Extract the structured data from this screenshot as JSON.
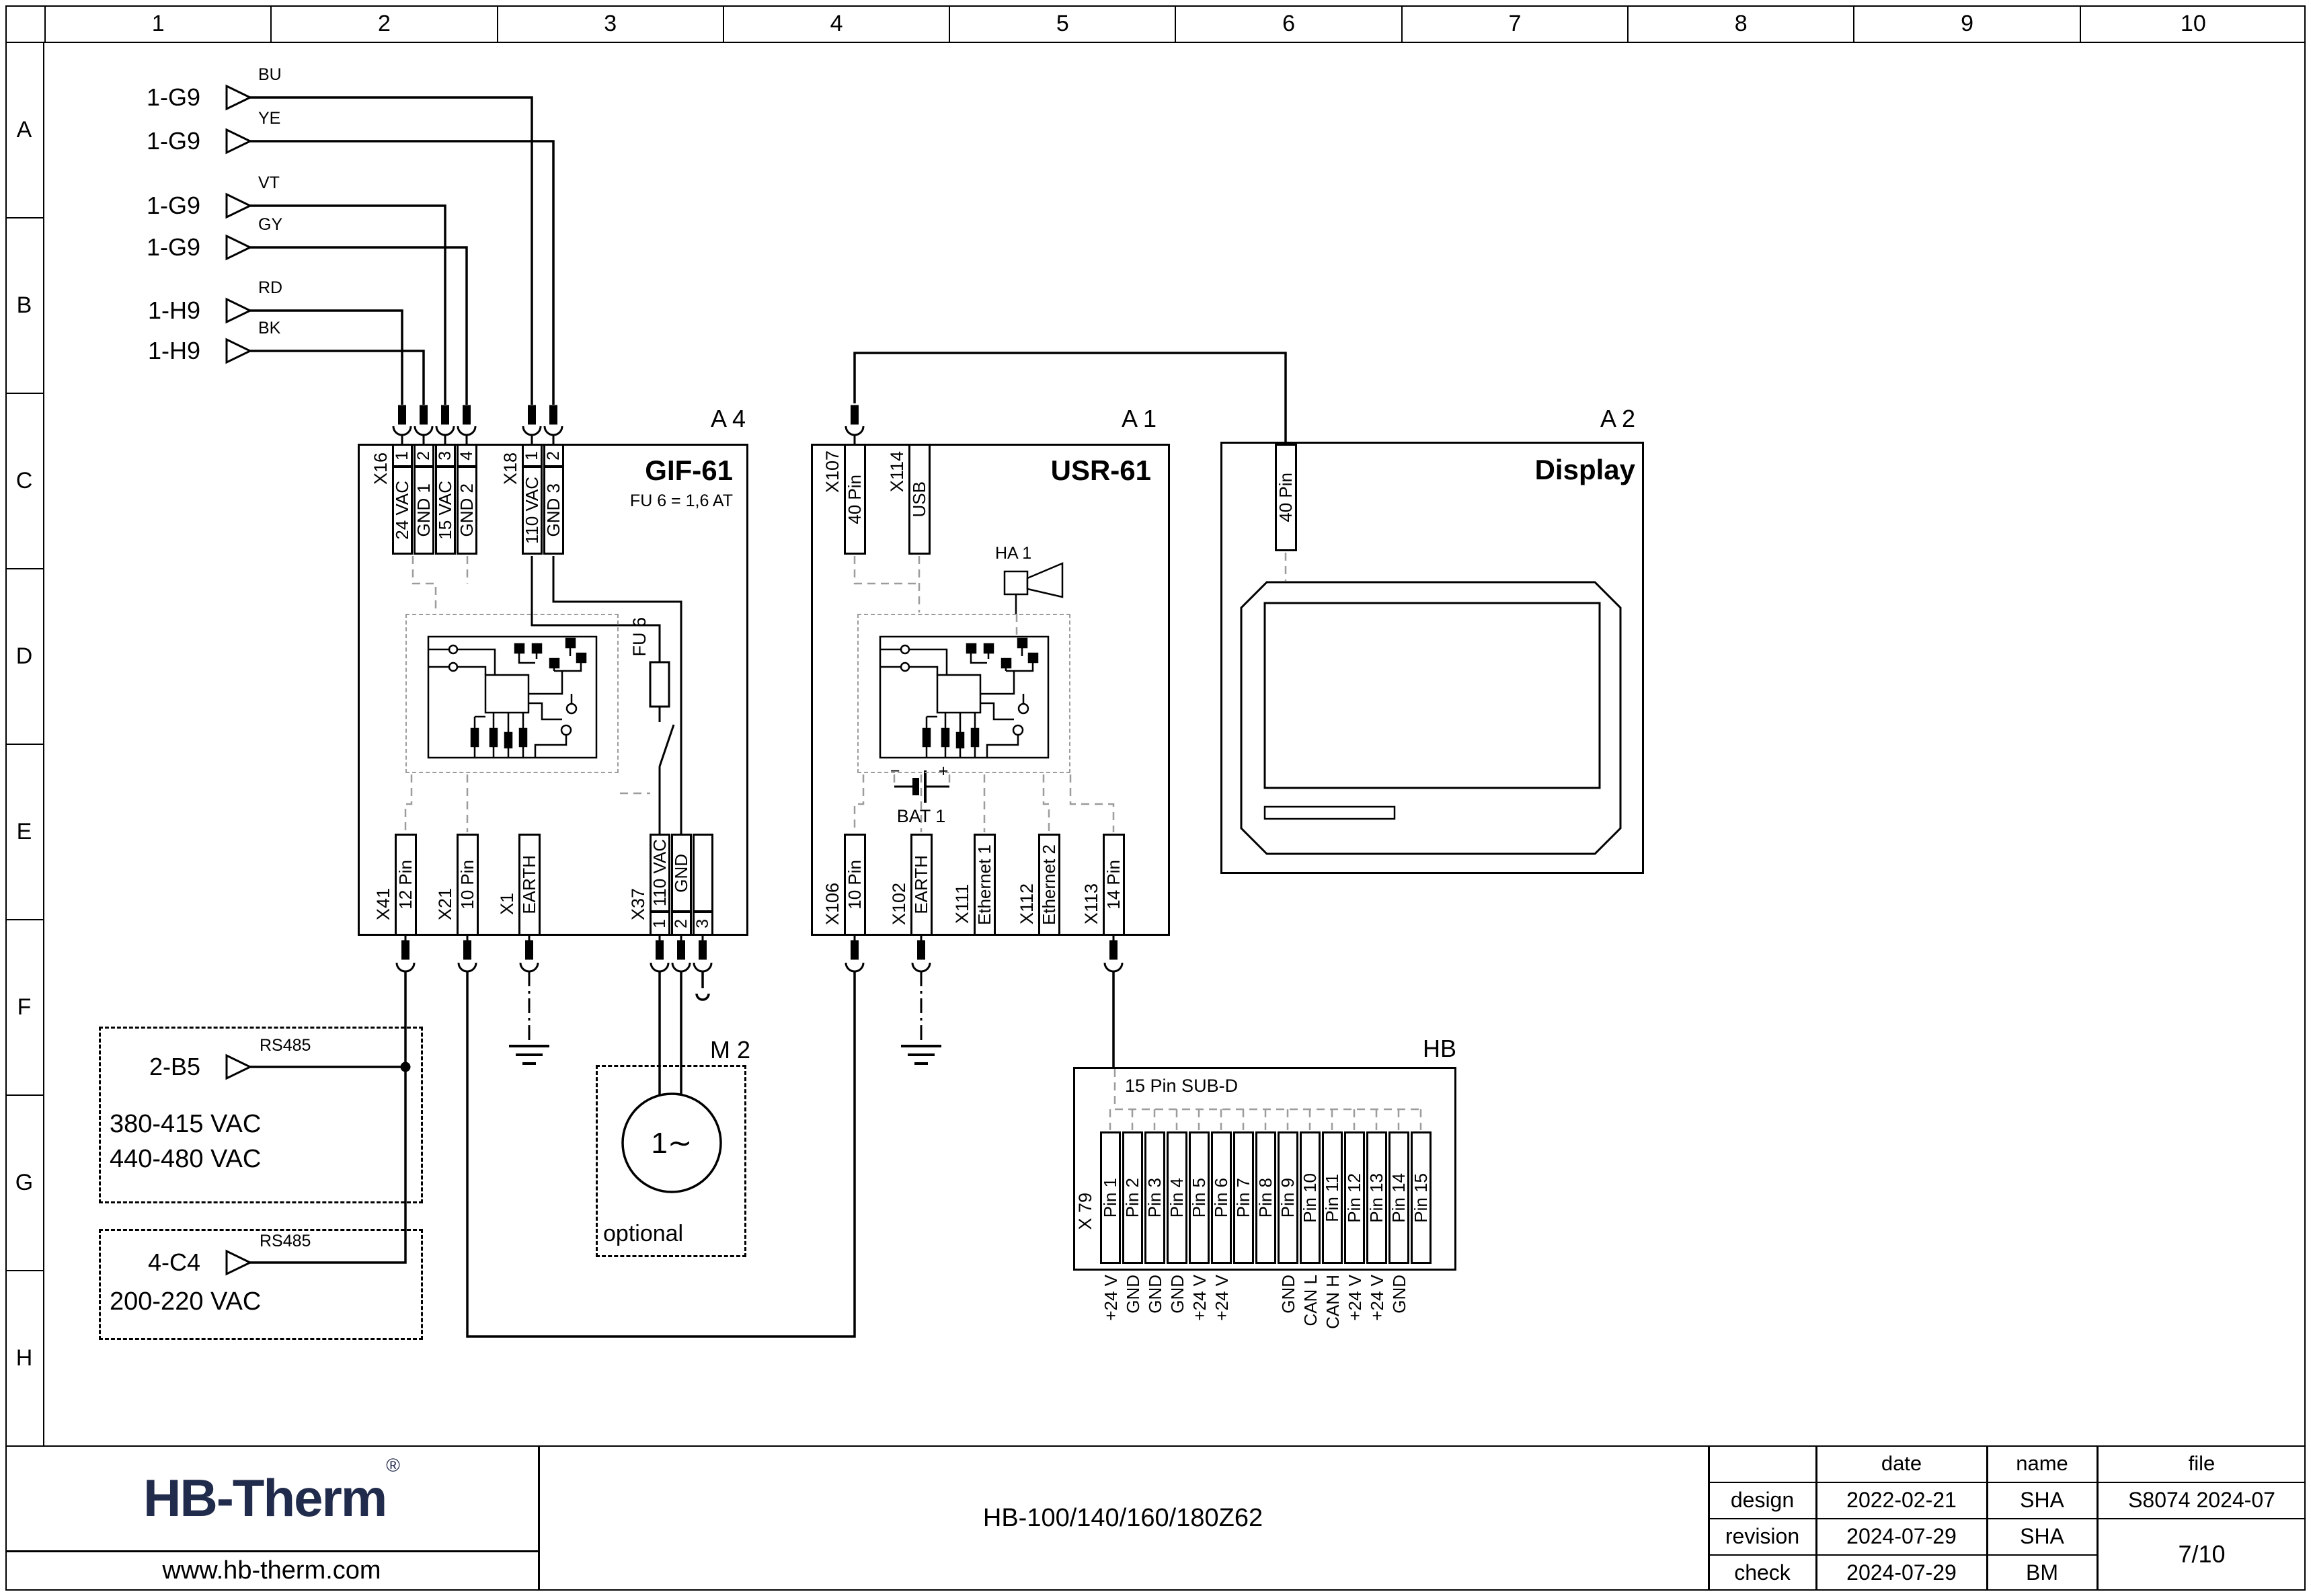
{
  "grid": {
    "columns": [
      "1",
      "2",
      "3",
      "4",
      "5",
      "6",
      "7",
      "8",
      "9",
      "10"
    ],
    "rows": [
      "A",
      "B",
      "C",
      "D",
      "E",
      "F",
      "G",
      "H"
    ]
  },
  "signals": [
    {
      "ref": "1-G9",
      "wire": "BU"
    },
    {
      "ref": "1-G9",
      "wire": "YE"
    },
    {
      "ref": "1-G9",
      "wire": "VT"
    },
    {
      "ref": "1-G9",
      "wire": "GY"
    },
    {
      "ref": "1-H9",
      "wire": "RD"
    },
    {
      "ref": "1-H9",
      "wire": "BK"
    }
  ],
  "a4": {
    "ref": "A 4",
    "title": "GIF-61",
    "subtitle": "FU 6 = 1,6 AT",
    "fuse": "FU 6",
    "x16": {
      "name": "X16",
      "pins": [
        {
          "n": "1",
          "label": "24 VAC"
        },
        {
          "n": "2",
          "label": "GND 1"
        },
        {
          "n": "3",
          "label": "15 VAC"
        },
        {
          "n": "4",
          "label": "GND 2"
        }
      ]
    },
    "x18": {
      "name": "X18",
      "pins": [
        {
          "n": "1",
          "label": "110 VAC"
        },
        {
          "n": "2",
          "label": "GND 3"
        }
      ]
    },
    "bottom": [
      {
        "name": "X41",
        "label": "12 Pin"
      },
      {
        "name": "X21",
        "label": "10 Pin"
      },
      {
        "name": "X1",
        "label": "EARTH"
      }
    ],
    "x37": {
      "name": "X37",
      "pins": [
        {
          "n": "1",
          "label": "110 VAC"
        },
        {
          "n": "2",
          "label": "GND"
        },
        {
          "n": "3",
          "label": ""
        }
      ]
    }
  },
  "a1": {
    "ref": "A 1",
    "title": "USR-61",
    "horn": "HA 1",
    "battery": "BAT 1",
    "battery_minus": "−",
    "battery_plus": "+",
    "top": [
      {
        "name": "X107",
        "label": "40 Pin"
      },
      {
        "name": "X114",
        "label": "USB"
      }
    ],
    "bottom": [
      {
        "name": "X106",
        "label": "10 Pin"
      },
      {
        "name": "X102",
        "label": "EARTH"
      },
      {
        "name": "X111",
        "label": "Ethernet 1"
      },
      {
        "name": "X112",
        "label": "Ethernet 2"
      },
      {
        "name": "X113",
        "label": "14 Pin"
      }
    ]
  },
  "a2": {
    "ref": "A 2",
    "title": "Display",
    "connector": "40 Pin"
  },
  "m2": {
    "ref": "M 2",
    "phase": "1∼",
    "note": "optional"
  },
  "hb": {
    "ref": "HB",
    "connector_title": "15 Pin SUB-D",
    "name": "X 79",
    "pins": [
      "Pin 1",
      "Pin 2",
      "Pin 3",
      "Pin 4",
      "Pin 5",
      "Pin 6",
      "Pin 7",
      "Pin 8",
      "Pin 9",
      "Pin 10",
      "Pin 11",
      "Pin 12",
      "Pin 13",
      "Pin 14",
      "Pin 15"
    ],
    "pin_functions": [
      "+24 V",
      "GND",
      "GND",
      "GND",
      "+24 V",
      "+24 V",
      "",
      "",
      "GND",
      "CAN L",
      "CAN H",
      "+24 V",
      "+24 V",
      "GND",
      ""
    ]
  },
  "sources": [
    {
      "ref": "2-B5",
      "bus": "RS485",
      "lines": [
        "380-415 VAC",
        "440-480 VAC"
      ]
    },
    {
      "ref": "4-C4",
      "bus": "RS485",
      "lines": [
        "200-220 VAC"
      ]
    }
  ],
  "title_block": {
    "logo": "HB-Therm",
    "reg": "®",
    "website": "www.hb-therm.com",
    "model": "HB-100/140/160/180Z62",
    "table": {
      "headers": [
        "",
        "date",
        "name",
        "file"
      ],
      "rows": [
        {
          "label": "design",
          "date": "2022-02-21",
          "name": "SHA"
        },
        {
          "label": "revision",
          "date": "2024-07-29",
          "name": "SHA"
        },
        {
          "label": "check",
          "date": "2024-07-29",
          "name": "BM"
        }
      ],
      "file": "S8074 2024-07",
      "page": "7/10"
    }
  },
  "colors": {
    "logo_navy": "#212b4c",
    "dash_gray": "#9c9c9c"
  }
}
